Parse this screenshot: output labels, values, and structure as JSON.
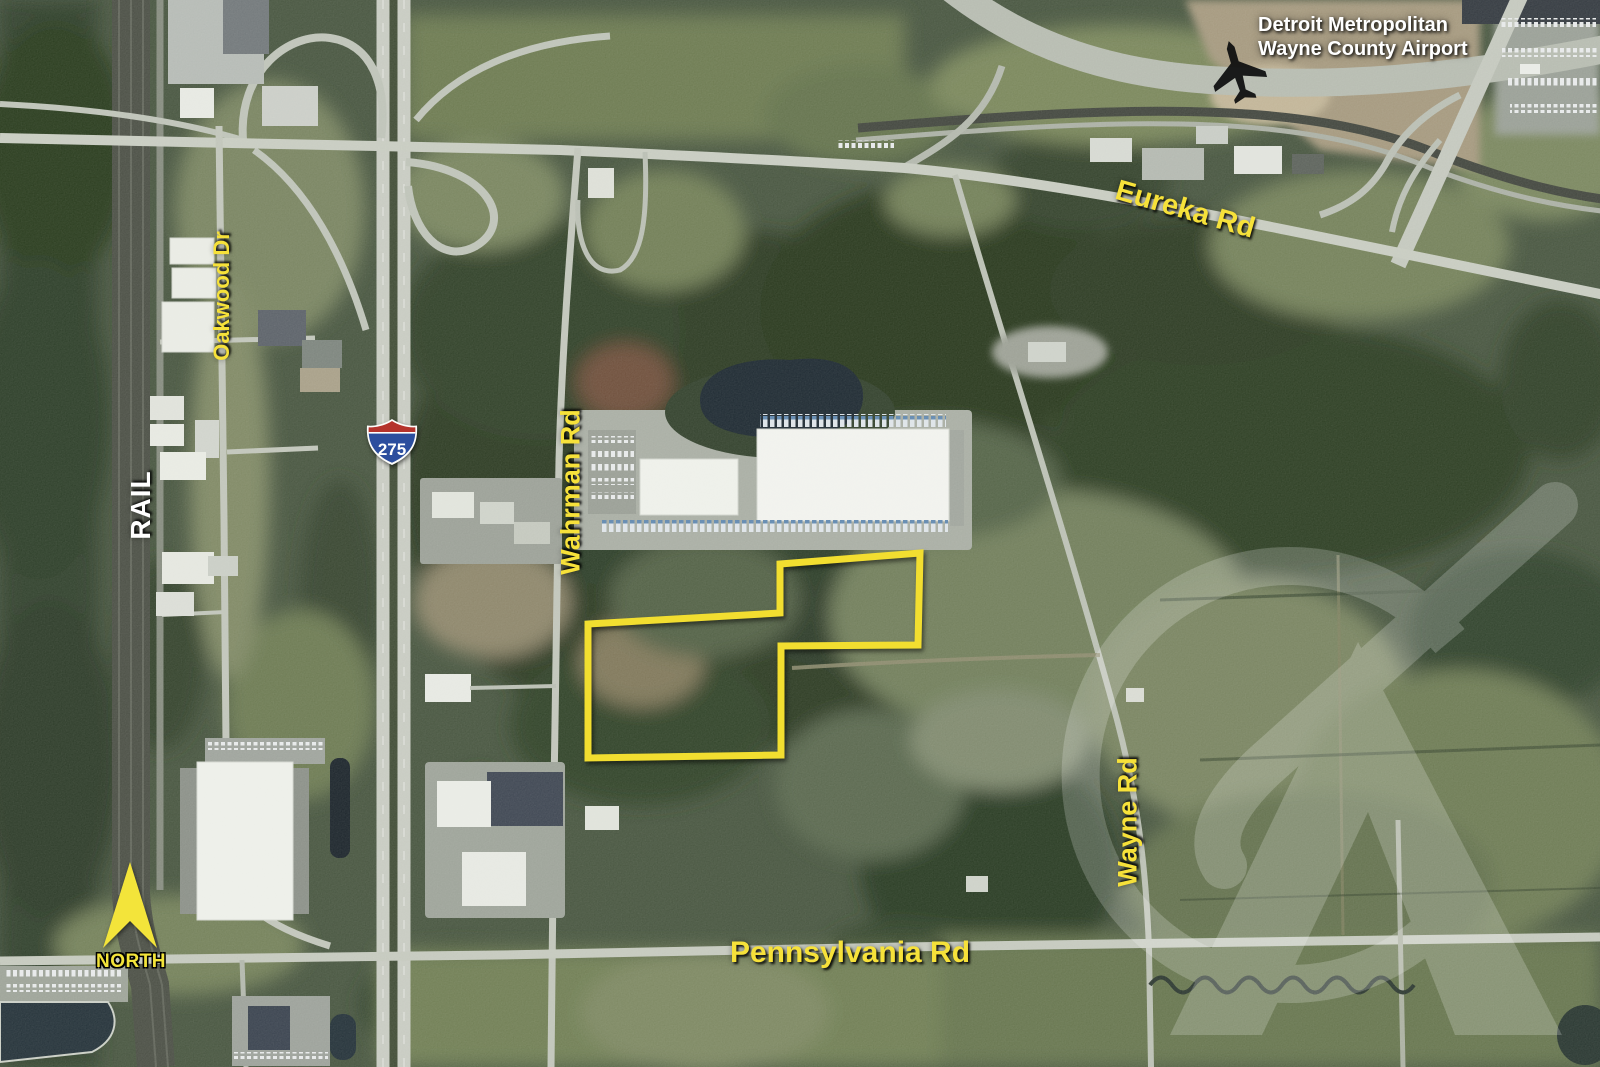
{
  "map": {
    "title": "Aerial site map",
    "labels": {
      "airport_line1": "Detroit Metropolitan",
      "airport_line2": "Wayne County Airport",
      "eureka": "Eureka Rd",
      "oakwood": "Oakwood Dr",
      "wahrman": "Wahrman Rd",
      "wayne": "Wayne Rd",
      "pennsylvania": "Pennsylvania Rd",
      "rail": "RAIL",
      "north": "NORTH",
      "interstate": "275"
    },
    "colors": {
      "road_label_yellow": "#F6E13A",
      "label_white": "#FFFFFF",
      "property_outline_yellow": "#F2DE30",
      "shield_red": "#B5332C",
      "shield_blue": "#2C4E9E",
      "watermark_white": "#FFFFFF",
      "north_arrow_yellow": "#F3E43A"
    }
  }
}
